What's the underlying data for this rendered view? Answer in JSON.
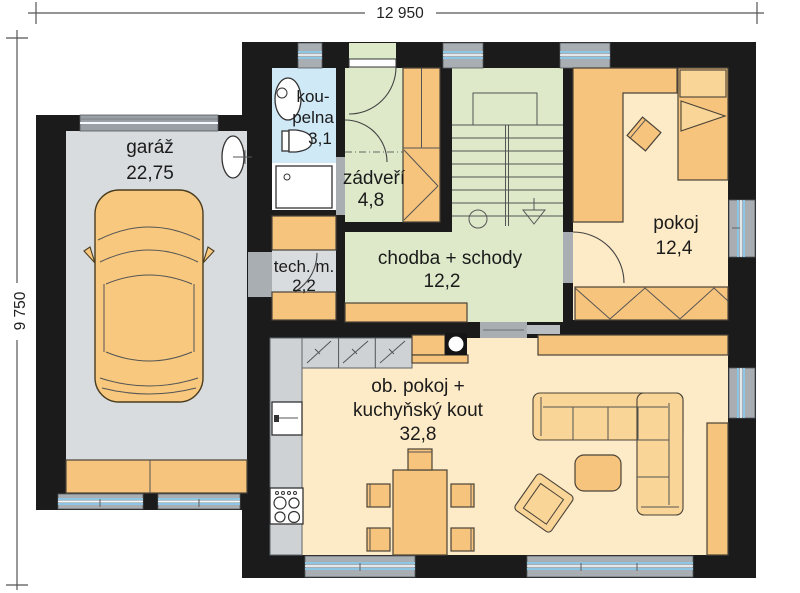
{
  "dimensions": {
    "width": "12 950",
    "height": "9 750"
  },
  "rooms": {
    "garage": {
      "name": "garáž",
      "area": "22,75"
    },
    "bathroom": {
      "name_line1": "kou-",
      "name_line2": "pelna",
      "area": "3,1"
    },
    "vestibule": {
      "name": "zádveří",
      "area": "4,8"
    },
    "tech": {
      "name": "tech. m.",
      "area": "2,2"
    },
    "hallway": {
      "name": "chodba + schody",
      "area": "12,2"
    },
    "bedroom": {
      "name": "pokoj",
      "area": "12,4"
    },
    "living": {
      "name_line1": "ob. pokoj +",
      "name_line2": "kuchyňský kout",
      "area": "32,8"
    }
  },
  "colors": {
    "wall": "#1b1b1b",
    "floor_garage": "#d9dcdf",
    "floor_bathroom": "#cfe9f7",
    "floor_green": "#dde9c9",
    "floor_cream": "#fdeac6",
    "furniture_orange": "#f6c47c",
    "furniture_light": "#f9d598",
    "counter_gray": "#ced2d5",
    "window_gray": "#a9aeb3",
    "window_glass": "#8cc6e4"
  }
}
